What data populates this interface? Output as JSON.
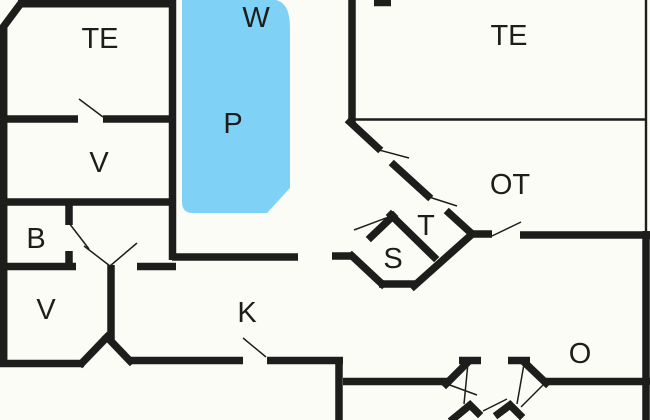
{
  "plan": {
    "type": "floor-plan",
    "rooms": {
      "te_left": {
        "label": "TE"
      },
      "w": {
        "label": "W"
      },
      "p": {
        "label": "P"
      },
      "te_right": {
        "label": "TE"
      },
      "ot": {
        "label": "OT"
      },
      "v_top": {
        "label": "V"
      },
      "b": {
        "label": "B"
      },
      "v_bottom": {
        "label": "V"
      },
      "k": {
        "label": "K"
      },
      "t": {
        "label": "T"
      },
      "s": {
        "label": "S"
      },
      "o": {
        "label": "O"
      }
    },
    "colors": {
      "wall": "#1d1d1b",
      "background": "#fcfcf7",
      "pool": "#7fd2f6"
    }
  }
}
